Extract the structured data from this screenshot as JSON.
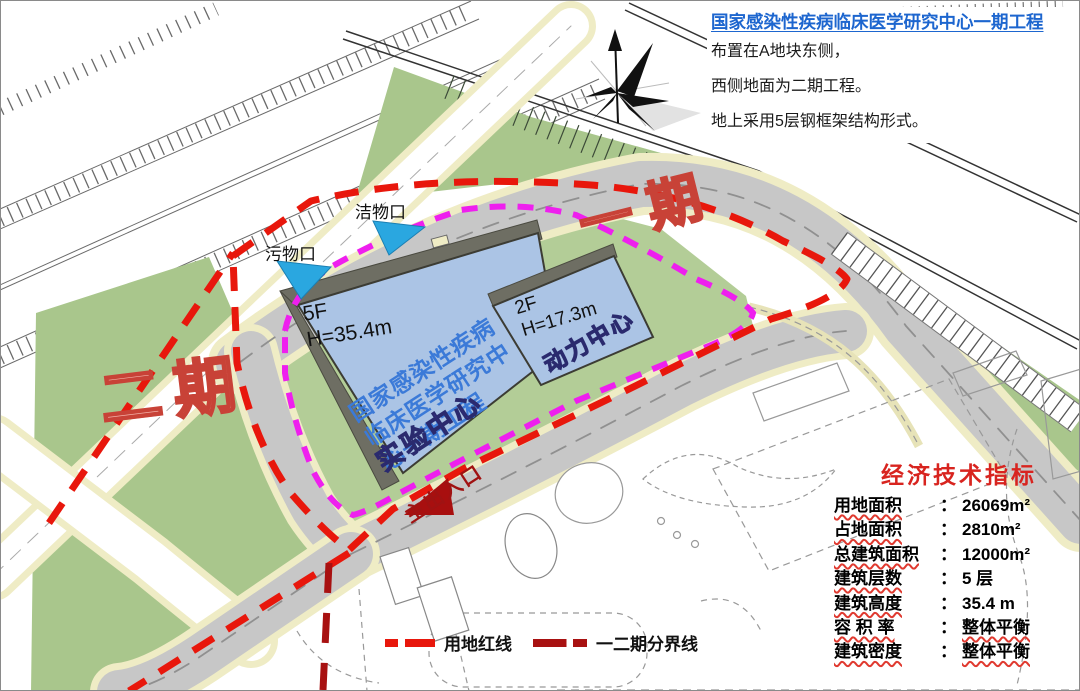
{
  "header": {
    "title": "国家感染性疾病临床医学研究中心一期工程",
    "lines": [
      "布置在A地块东侧，",
      "西侧地面为二期工程。",
      "地上采用5层钢框架结构形式。"
    ]
  },
  "phases": {
    "phase1_label": "一期",
    "phase2_label": "二期"
  },
  "buildings": {
    "main": {
      "floors": "5F",
      "height": "H=35.4m",
      "name_lines": [
        "国家感染性疾病",
        "临床医学研究中",
        "心一期工程"
      ],
      "function_label": "实验中心"
    },
    "power": {
      "floors": "2F",
      "height": "H=17.3m",
      "function_label": "动力中心"
    }
  },
  "entrances": {
    "clean_label": "洁物口",
    "dirty_label": "污物口",
    "main_label": "主出入口"
  },
  "legend": {
    "items": [
      {
        "label": "用地红线"
      },
      {
        "label": "一二期分界线"
      }
    ]
  },
  "indicators": {
    "title": "经济技术指标",
    "colon": "：",
    "rows": [
      {
        "label": "用地面积",
        "value": "26069m²"
      },
      {
        "label": "占地面积",
        "value": "2810m²"
      },
      {
        "label": "总建筑面积",
        "value": "12000m²"
      },
      {
        "label": "建筑层数",
        "value": "5 层"
      },
      {
        "label": "建筑高度",
        "value": "35.4 m"
      },
      {
        "label": "容 积 率",
        "value": "整体平衡"
      },
      {
        "label": "建筑密度",
        "value": "整体平衡"
      }
    ]
  },
  "colors": {
    "boundary_red": "#e8170c",
    "divider_dark_red": "#a81111",
    "magenta_line": "#ee1fee",
    "entrance_cyan": "#2aa7e0",
    "building_blue": "#abc4e5",
    "green": "#a9c68c",
    "road_gray": "#c7c7c7",
    "header_blue": "#1d66cf",
    "indicator_red": "#d8241f",
    "phase_text_red": "#c84237",
    "building_name_purple": "#6d2fd0"
  }
}
